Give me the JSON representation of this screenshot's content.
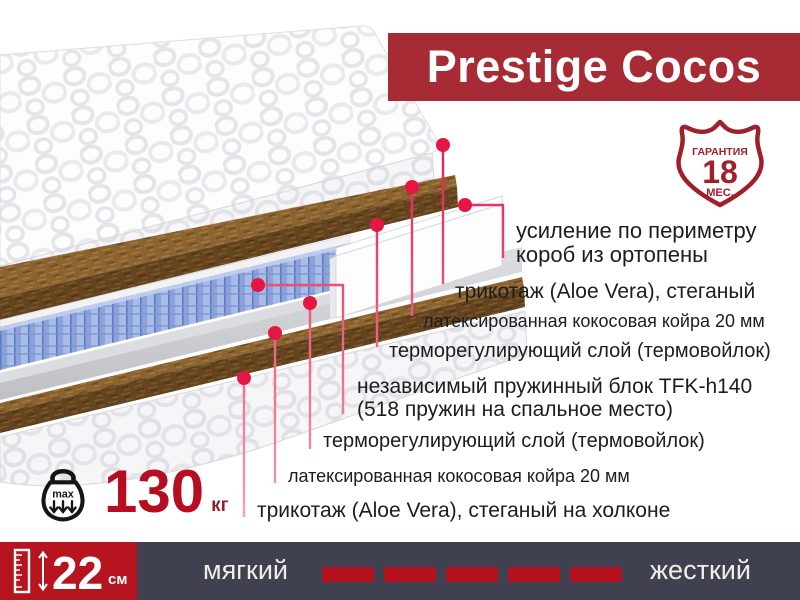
{
  "title": "Prestige Cocos",
  "badge": {
    "top": "ГАРАНТИЯ",
    "number": "18",
    "bottom": "МЕС."
  },
  "annotations": [
    {
      "line1": "усиление по периметру",
      "line2": "короб из ортопены"
    },
    {
      "line1": "трикотаж (Aloe Vera), стеганый",
      "line2": ""
    },
    {
      "line1": "латексированная кокосовая койра 20 мм",
      "line2": ""
    },
    {
      "line1": "терморегулирующий слой (термовойлок)",
      "line2": ""
    },
    {
      "line1": "независимый пружинный блок TFK-h140",
      "line2": "(518 пружин на спальное место)"
    },
    {
      "line1": "терморегулирующий слой (термовойлок)",
      "line2": ""
    },
    {
      "line1": "латексированная кокосовая койра 20 мм",
      "line2": ""
    },
    {
      "line1": "трикотаж (Aloe Vera), стеганый на холконе",
      "line2": ""
    }
  ],
  "max_load": {
    "icon_text": "max",
    "value": "130",
    "unit": "кг"
  },
  "height_bar": {
    "value": "22",
    "unit": "см"
  },
  "firmness": {
    "soft_label": "мягкий",
    "hard_label": "жесткий",
    "blocks": 5
  },
  "colors": {
    "banner_red": "#a62b34",
    "accent_red": "#b5121f",
    "navy": "#3f4150",
    "leader_red": "#e41744",
    "shield_red": "#9f1f2b"
  }
}
